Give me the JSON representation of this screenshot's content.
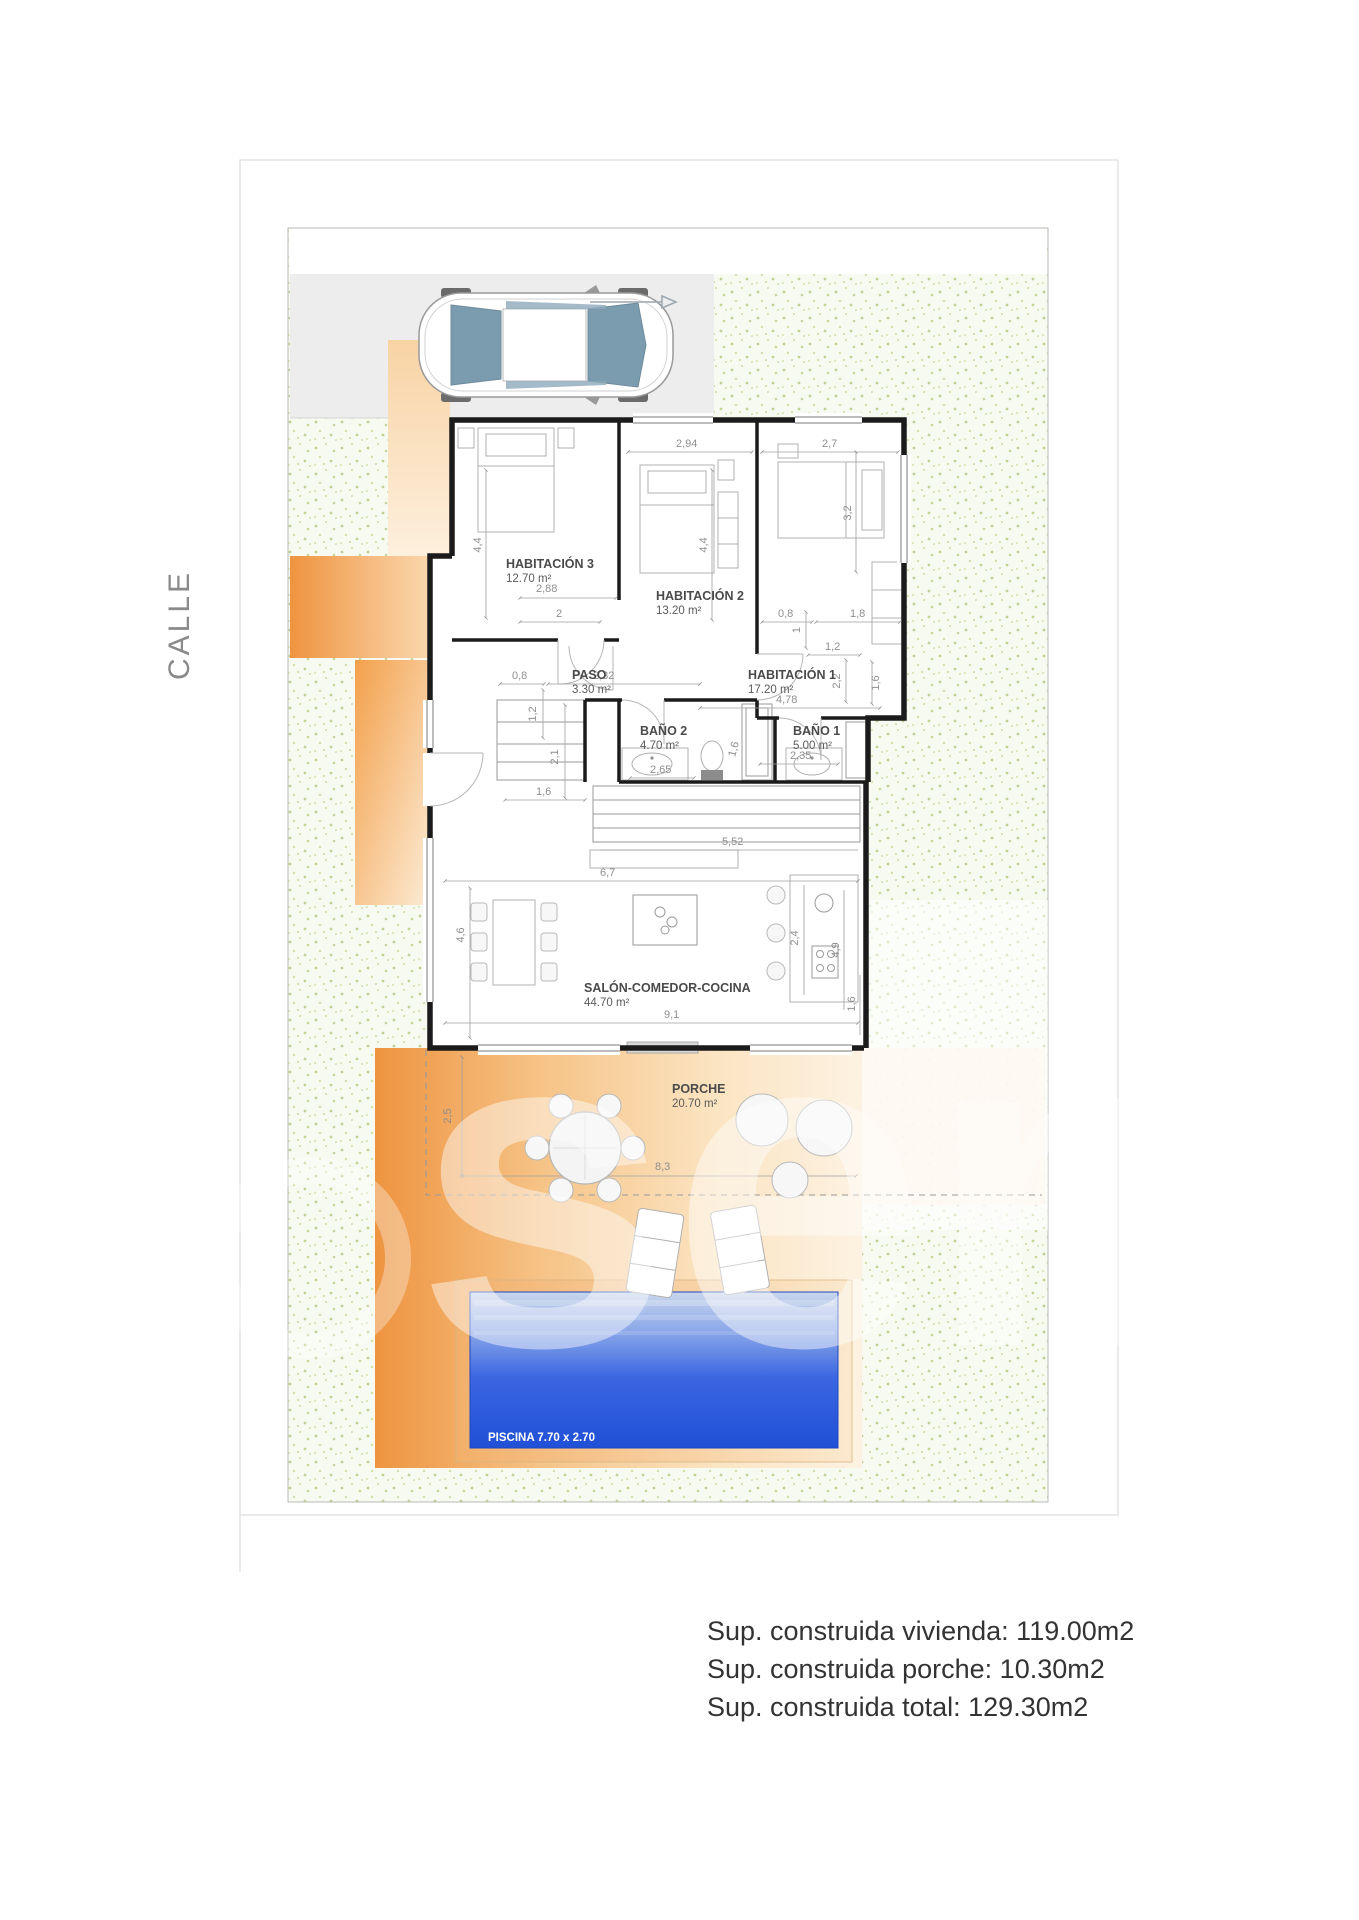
{
  "street_label": "CALLE",
  "watermark": {
    "text": "sen"
  },
  "rooms": {
    "hab3": {
      "name": "HABITACIÓN 3",
      "area": "12.70 m²"
    },
    "hab2": {
      "name": "HABITACIÓN 2",
      "area": "13.20 m²"
    },
    "hab1": {
      "name": "HABITACIÓN 1",
      "area": "17.20 m²"
    },
    "paso": {
      "name": "PASO",
      "area": "3.30 m²"
    },
    "bano2": {
      "name": "BAÑO 2",
      "area": "4.70 m²"
    },
    "bano1": {
      "name": "BAÑO 1",
      "area": "5.00 m²"
    },
    "salon": {
      "name": "SALÓN-COMEDOR-COCINA",
      "area": "44.70 m²"
    },
    "porche": {
      "name": "PORCHE",
      "area": "20.70 m²"
    }
  },
  "pool": {
    "label": "PISCINA 7.70 x 2.70"
  },
  "dims": {
    "hab2_w": "2,94",
    "hab1_w": "2,7",
    "hab3_h": "4,4",
    "hab2_h": "4,4",
    "hab1_bed": "3,2",
    "hab3_w": "2,88",
    "hab3_w2": "2",
    "paso_a": "0,8",
    "paso_w": "2,32",
    "paso_h": "1,2",
    "nook_a": "0,8",
    "nook_b": "1,8",
    "nook_c": "1,2",
    "nook_d": "2,2",
    "nook_e": "1,6",
    "hab1_door": "1",
    "hab1_d": "4,78",
    "bano2_h": "2,1",
    "bano2_l": "1,6",
    "bano2_w": "2,65",
    "bano2_s": "1,6",
    "bano1_w": "2,35",
    "counter": "5,52",
    "salon_w": "6,7",
    "salon_h": "4,6",
    "salon_w2": "9,1",
    "island": "2,4",
    "kitchen": "4,9",
    "salon_r": "1,6",
    "porch_h": "2,5",
    "porch_w": "8,3"
  },
  "summary": [
    "Sup. construida vivienda: 119.00m2",
    "Sup. construida porche: 10.30m2",
    "Sup. construida total: 129.30m2"
  ],
  "colors": {
    "wall": "#1b1b1b",
    "grass_base": "#f7faf0",
    "parking": "#ededed",
    "orange": "#f0964a",
    "pool_deep": "#2b57dd",
    "pool_light": "#c9d6ec",
    "dim_text": "#8f8f8f"
  }
}
